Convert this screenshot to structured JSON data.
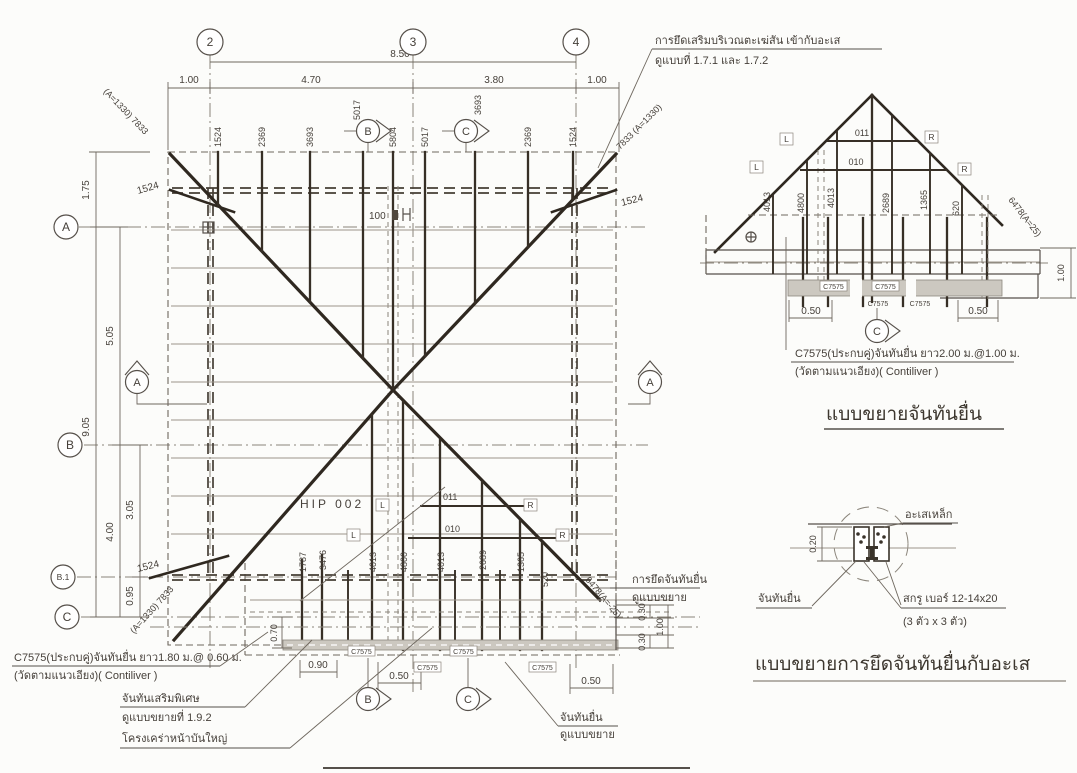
{
  "plan": {
    "grid": {
      "c2": "2",
      "c3": "3",
      "c4": "4",
      "rA": "A",
      "rB": "B",
      "rB1": "B.1",
      "rC": "C"
    },
    "dims": {
      "overall_top": "8.50",
      "left_oh": "1.00",
      "span23": "4.70",
      "span34": "3.80",
      "right_oh": "1.00",
      "v175": "1.75",
      "v905": "9.05",
      "v505": "5.05",
      "v400": "4.00",
      "v305": "3.05",
      "v095": "0.95",
      "d090": "0.90",
      "d050_left": "0.50",
      "d050_right": "0.50",
      "d070": "0.70",
      "d030_a": "0.30",
      "d030_b": "0.30",
      "d100_right": "1.00"
    },
    "rafters_top": [
      "1524",
      "2369",
      "3693",
      "5017",
      "5804",
      "5017",
      "3693",
      "2369",
      "1524"
    ],
    "rafters_bottom": [
      "1787",
      "3476",
      "4013",
      "4800",
      "4013",
      "2689",
      "1365",
      "520"
    ],
    "hip_tl": "(A=1330) 7833",
    "hip_tr": "7833 (A=1330)",
    "hip_bl": "(A=1330) 7833",
    "diag_br": "6478(A=-25)",
    "jack": "1524",
    "label_100": "100",
    "hip_id": "HIP 002",
    "m011": "011",
    "m010": "010"
  },
  "sym": {
    "L": "L",
    "R": "R",
    "channel": "C7575"
  },
  "marks": {
    "A": "A",
    "B": "B",
    "C": "C"
  },
  "notes": {
    "top1": "การยึดเสริมบริเวณตะเฆ่สัน เข้ากับอะเส",
    "top2": "ดูแบบที่ 1.7.1 และ 1.7.2",
    "left1": "C7575(ประกบคู่)จันทันยื่น ยาว1.80 ม.@ 0.60 ม.",
    "left2": "(วัดตามแนวเอียง)( Contiliver )",
    "left3": "จันทันเสริมพิเศษ",
    "left4": "ดูแบบขยายที่ 1.9.2",
    "left5": "โครงเคร่าหน้าบันใหญ่",
    "right1": "การยึดจันทันยื่น",
    "right2": "ดูแบบขยาย",
    "bottom1": "จันทันยื่น",
    "bottom2": "ดูแบบขยาย"
  },
  "gable": {
    "studs": [
      "4013",
      "4800",
      "4013",
      "2689",
      "1365",
      "620"
    ],
    "m011": "011",
    "m010": "010",
    "diag": "6478(A=25)",
    "d100": "1.00",
    "d050_left": "0.50",
    "d050_right": "0.50",
    "note1": "C7575(ประกบคู่)จันทันยื่น ยาว2.00 ม.@1.00 ม.",
    "note2": "(วัดตามแนวเอียง)( Contiliver )",
    "title": "แบบขยายจันทันยื่น"
  },
  "joint": {
    "purlin_label": "อะเสเหล็ก",
    "rafter_label": "จันทันยื่น",
    "screw1": "สกรู เบอร์ 12-14x20",
    "screw2": "(3 ตัว x 3 ตัว)",
    "d020": "0.20",
    "title": "แบบขยายการยึดจันทันยื่นกับอะเส"
  }
}
